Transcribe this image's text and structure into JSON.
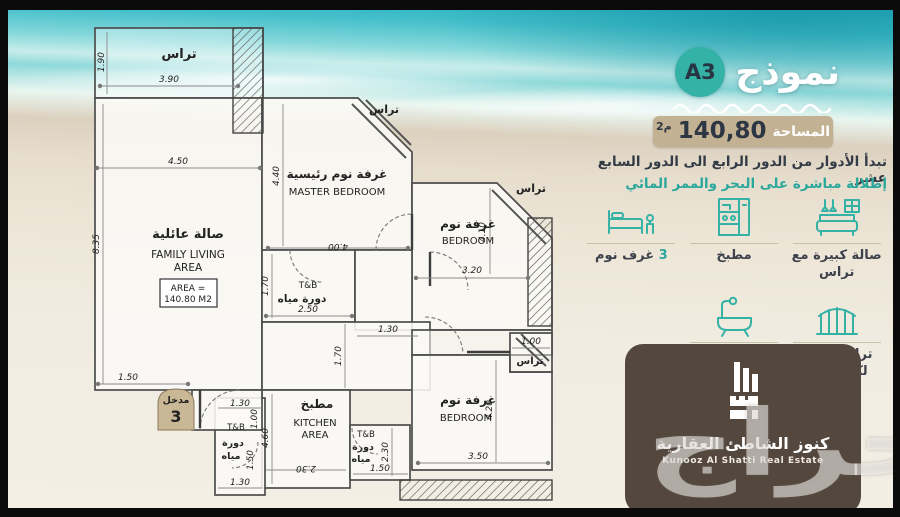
{
  "title": {
    "model_word": "نموذج",
    "model_code": "A3"
  },
  "area_badge": {
    "label": "المساحة",
    "value": "140,80",
    "unit": "م2"
  },
  "description": {
    "line1": "تبدأ الأدوار من الدور الرابع الى الدور السابع عشر",
    "line2": "إطلالة مباشرة على البحر والممر المائي"
  },
  "features": [
    {
      "icon": "sofa-icon",
      "count": "",
      "label": "صالة كبيرة مع تراس"
    },
    {
      "icon": "kitchen-icon",
      "count": "",
      "label": "مطبخ"
    },
    {
      "icon": "bed-icon",
      "count": "3",
      "label": "غرف نوم"
    },
    {
      "icon": "fence-icon",
      "count": "",
      "label": "تراس خاص لكل غرفة"
    },
    {
      "icon": "bathtub-icon",
      "count": "3",
      "label": "دورة مياه"
    }
  ],
  "logo": {
    "name_ar": "كنوز الشاطئ العقارية",
    "name_en": "Kunooz Al Shatti Real Estate"
  },
  "watermark": "حراج",
  "floorplan": {
    "rooms": {
      "terrace": "تراس",
      "family_ar": "صالة عائلية",
      "family_en_1": "FAMILY LIVING",
      "family_en_2": "AREA",
      "area_box_1": "AREA =",
      "area_box_2": "140.80 M2",
      "master_ar": "غرفة نوم رئيسية",
      "master_en": "MASTER BEDROOM",
      "bedroom_ar": "غرفة نوم",
      "bedroom_en": "BEDROOM",
      "kitchen_ar": "مطبخ",
      "kitchen_en_1": "KITCHEN",
      "kitchen_en_2": "AREA",
      "tb": "T&B",
      "wc": "دورة مياه",
      "wc_1": "دورة",
      "wc_2": "مياه",
      "entrance": "مدخل",
      "entrance_no": "3"
    },
    "dims": {
      "terrace_h": "1.90",
      "terrace_w": "3.90",
      "family_w": "4.50",
      "family_h": "8.35",
      "master_h": "4.40",
      "master_w": "4.00",
      "bed1_w": "3.20",
      "bed1_h": "4.10",
      "tb1_h": "1.70",
      "tb1_w": "2.50",
      "hall_w": "1.30",
      "hall_h": "1.70",
      "kitchen_h": "4.60",
      "kitchen_w": "2.30",
      "tb2_h": "2.30",
      "tb2_w": "1.50",
      "bed2_h": "4.20",
      "bed2_w": "3.50",
      "bed2_terrace": "1.00",
      "entry_w": "1.50",
      "tb3_top": "1.30",
      "tb3_a": "1.00",
      "tb3_b": "1.50",
      "tb3_bot": "1.30"
    }
  },
  "colors": {
    "teal": "#35b2a6",
    "tan": "#c2b192",
    "dark": "#323a45",
    "brown": "#54483e"
  }
}
